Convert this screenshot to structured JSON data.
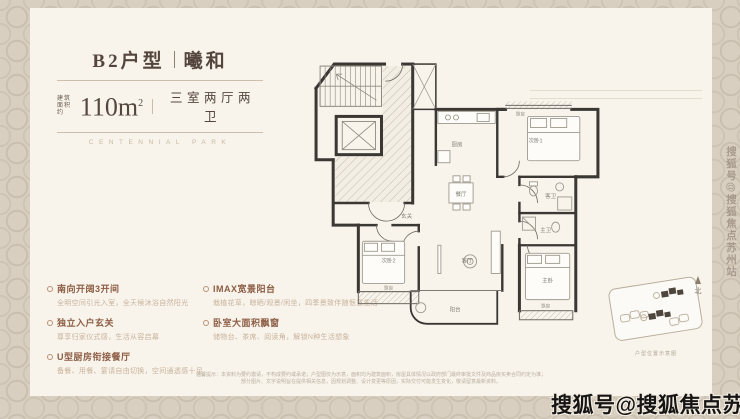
{
  "header": {
    "unit_code": "B2户型",
    "unit_name": "曦和",
    "area_prefix_line1": "建筑",
    "area_prefix_line2": "面积约",
    "area_value": "110m",
    "area_sup": "2",
    "layout_text": "三室两厅两卫",
    "subtitle_en": "CENTENNIAL PARK"
  },
  "features": {
    "left": [
      {
        "title": "南向开阔3开间",
        "desc": "全明空间引光入室，全天候沐浴自然阳光"
      },
      {
        "title": "独立入户玄关",
        "desc": "尊享归家仪式感，生活从容启幕"
      },
      {
        "title": "U型厨房衔接餐厅",
        "desc": "备餐、用餐、宴请自由切换，空间通透感十足"
      }
    ],
    "right": [
      {
        "title": "IMAX宽景阳台",
        "desc": "栽植花草，晾晒/观景/闲坐，四季景致伴随惬意生活"
      },
      {
        "title": "卧室大面积飘窗",
        "desc": "储物台、茶席、阅读角，解锁N种生活想象"
      }
    ]
  },
  "floorplan": {
    "rooms": {
      "kitchen": "厨房",
      "dining": "餐厅",
      "foyer": "玄关",
      "bedroom1": "次卧1",
      "bay1": "飘窗",
      "guest_bath": "客卫",
      "master_bath": "主卫",
      "master": "主卧",
      "bay_master": "飘窗",
      "living": "客厅",
      "balcony": "阳台",
      "bedroom2": "次卧2",
      "bay2": "飘窗"
    },
    "minimap_caption": "户型位置示意图",
    "compass": "北"
  },
  "disclaimer": {
    "line1": "温馨提示：本资料为要约邀请，不构成要约或承诺；户型图仅为示意，面积均为建筑面积，房屋具体情况以政府部门最终审批文件及商品房买卖合同约定为准；",
    "line2": "部分图片、文字说明旨在提供相关信息，因规划调整、设计变更等原因，实际交付可能发生变化，敬请留意最新资料。"
  },
  "watermarks": {
    "vertical": "搜狐号@搜狐焦点苏州站",
    "bottom": "搜狐号@搜狐焦点苏州站"
  },
  "colors": {
    "background_pattern": "#d9cfc0",
    "card": "#f8f4ec",
    "title_text": "#54463e",
    "feature_title": "#8c5c43",
    "feature_desc": "#c9b29a",
    "plan_wall": "#3b3834",
    "watermark_bottom": "#171514"
  }
}
